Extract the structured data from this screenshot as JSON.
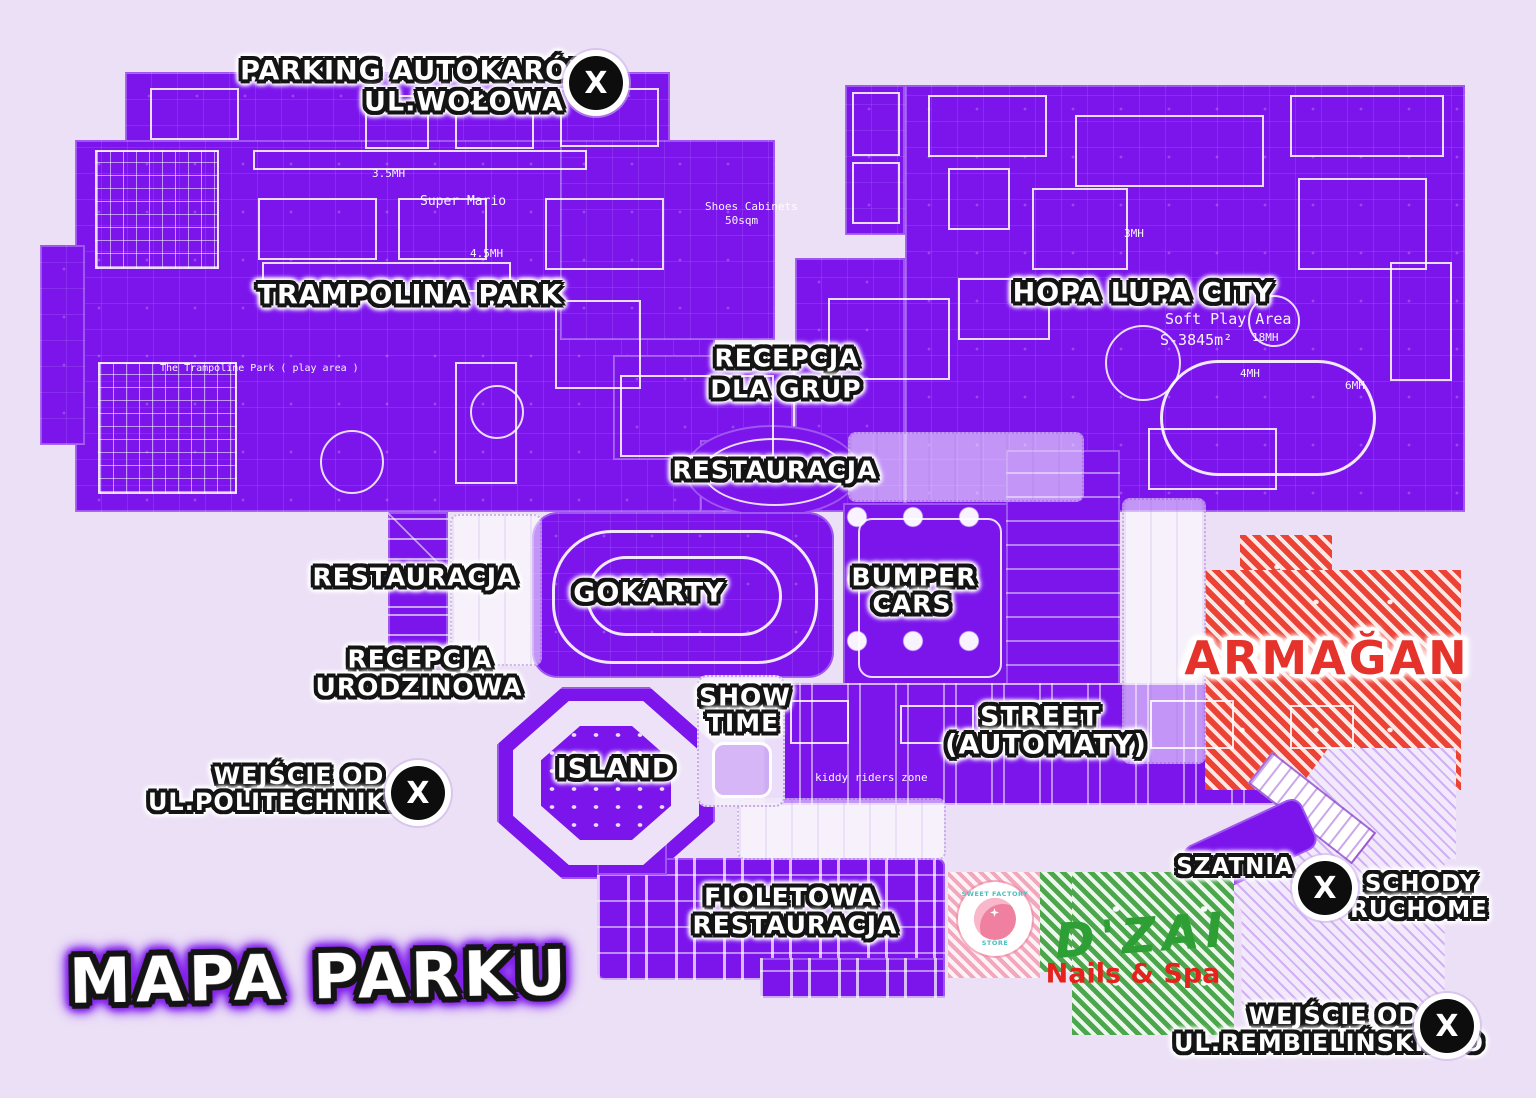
{
  "title": {
    "text": "MAPA PARKU"
  },
  "badges": {
    "x_glyph": "X"
  },
  "colors": {
    "background": "#ECE0F6",
    "zone_purple": "#7B15EC",
    "linework_white": "#FFFFFF",
    "armagan_red": "#E5322B",
    "red_hatch": "#EC4337",
    "green_hatch": "#4CA64C",
    "dzai_green": "#2E9F35",
    "nails_red": "#E5221B",
    "pink_hatch": "#F2A8BC",
    "logo_teal": "#4BBFBF",
    "badge_black": "#0D0D0D"
  },
  "zone_labels": {
    "parking": {
      "line1": "PARKING AUTOKARÓW",
      "line2": "UL.WOŁOWA"
    },
    "trampolina_park": {
      "text": "TRAMPOLINA PARK"
    },
    "hopa_lupa_city": {
      "text": "HOPA LUPA CITY"
    },
    "recepcja_dla_grup": {
      "line1": "RECEPCJA",
      "line2": "DLA GRUP"
    },
    "restauracja_center": {
      "text": "RESTAURACJA"
    },
    "restauracja_left": {
      "text": "RESTAURACJA"
    },
    "gokarty": {
      "text": "GOKARTY"
    },
    "bumper_cars": {
      "line1": "BUMPER",
      "line2": "CARS"
    },
    "recepcja_urodzinowa": {
      "line1": "RECEPCJA",
      "line2": "URODZINOWA"
    },
    "show_time": {
      "line1": "SHOW",
      "line2": "TIME"
    },
    "island": {
      "text": "ISLAND"
    },
    "street_automaty": {
      "line1": "STREET",
      "line2": "(AUTOMATY)"
    },
    "armagan": {
      "text": "ARMAĞAN"
    },
    "wejscie_politechniki": {
      "line1": "WEJŚCIE OD",
      "line2": "UL.POLITECHNIKI"
    },
    "szatnia": {
      "text": "SZATNIA"
    },
    "schody_ruchome": {
      "line1": "SCHODY",
      "line2": "RUCHOME"
    },
    "fioletowa_restauracja": {
      "line1": "FIOLETOWA",
      "line2": "RESTAURACJA"
    },
    "dzai": {
      "name": "D'ZAI",
      "subtitle": "Nails & Spa"
    },
    "sweet_factory": {
      "line1": "SWEET FACTORY",
      "line2": "STORE"
    },
    "wejscie_rembielinskiego": {
      "line1": "WEJŚCIE OD",
      "line2": "UL.REMBIELIŃSKIEGO"
    }
  },
  "map_annotations": [
    {
      "text": "Super Mario"
    },
    {
      "text": "Shoes Cabinets"
    },
    {
      "text": "50sqm"
    },
    {
      "text": "The Trampoline Park ( play area )"
    },
    {
      "text": "Soft Play Area"
    },
    {
      "text": "S-3845m²"
    },
    {
      "text": "kiddy riders zone"
    },
    {
      "text": "3.5MH"
    },
    {
      "text": "4.5MH"
    },
    {
      "text": "3MH"
    },
    {
      "text": "18MH"
    },
    {
      "text": "4MH"
    },
    {
      "text": "6MH"
    }
  ]
}
